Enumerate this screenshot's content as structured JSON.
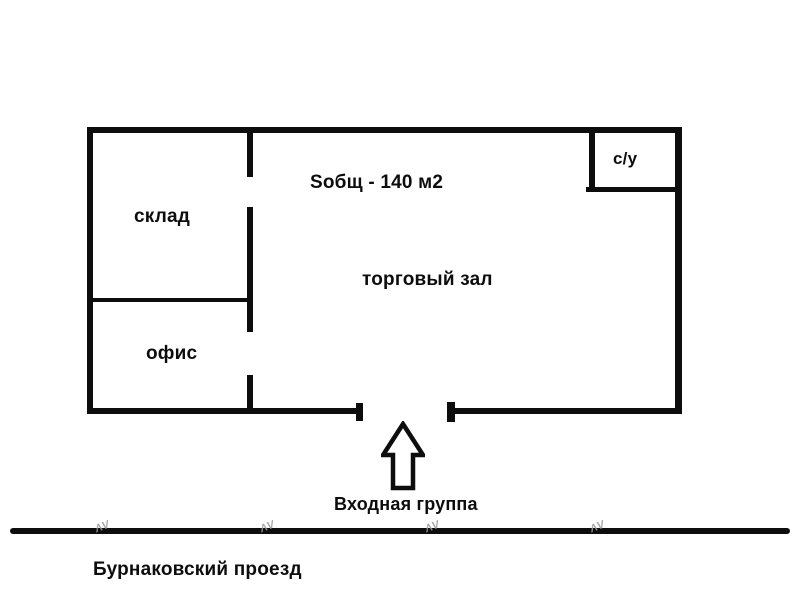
{
  "floorplan": {
    "area_label": "Sобщ - 140 м2",
    "rooms": {
      "storage": "склад",
      "office": "офис",
      "hall": "торговый зал",
      "wc": "с/у"
    },
    "entrance": {
      "label": "Входная группа",
      "arrow_icon": "up-arrow"
    },
    "street": {
      "label": "Бурнаковский проезд"
    },
    "watermark": {
      "mark": "ΛV"
    },
    "colors": {
      "wall": "#0d0d0d",
      "background": "#ffffff",
      "watermark": "#9a9a9a"
    }
  }
}
